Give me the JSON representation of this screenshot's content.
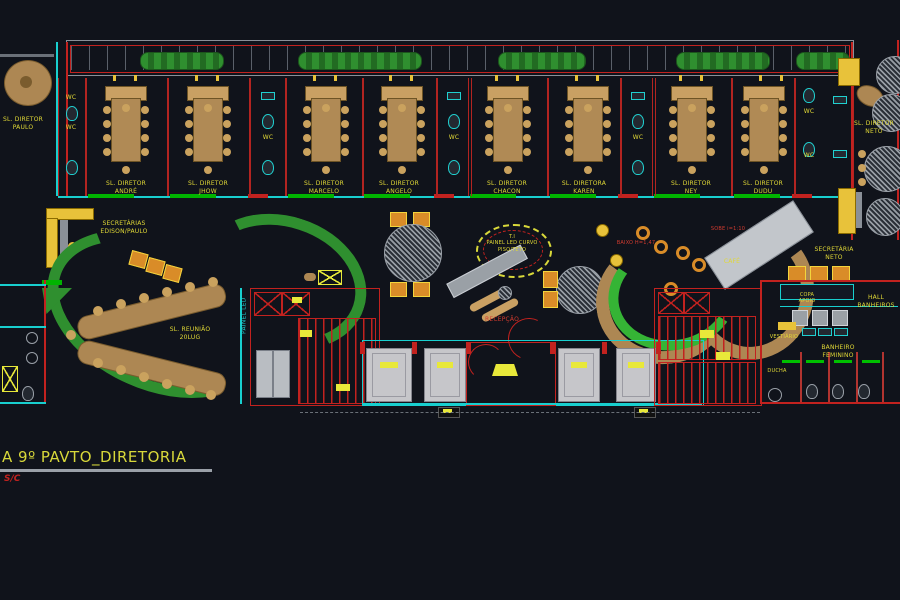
{
  "app": {
    "title": "A 9º PAVTO_DIRETORIA",
    "scale": "S/C"
  },
  "colors": {
    "background": "#10131b",
    "wall_cyan": "#18cfcf",
    "wall_red": "#c2221f",
    "wall_green": "#00b400",
    "label_yellow": "#e0d836",
    "furniture_tan": "#b08a55",
    "elevator_grey": "#c6c6ca",
    "plant_green": "#2f8f2f"
  },
  "rooms": {
    "director_paulo": "SL. DIRETOR\nPAULO",
    "director_andre": "SL. DIRETOR\nANDRÉ",
    "director_jhow": "SL. DIRETOR\nJHOW",
    "director_marcelo": "SL. DIRETOR\nMARCELO",
    "director_angelo": "SL. DIRETOR\nANGELO",
    "director_chacon": "SL. DIRETOR\nCHACON",
    "director_karen": "SL. DIRETORA\nKAREN",
    "director_ney": "SL. DIRETOR\nNEY",
    "director_dudu": "SL. DIRETOR\nDUDU",
    "director_neto": "SL. DIRETOR\nNETO",
    "secretarias_edison_paulo": "SECRETÁRIAS\nEDISON/PAULO",
    "secretaria_neto": "SECRETÁRIA\nNETO",
    "sala_reuniao": "SL. REUNIÃO\n20LUG",
    "painel_led": "PAINEL LED",
    "ti": "T.I\nPAINEL LED CURVO\nPISO/TETO",
    "recepcao": "RECEPÇÃO",
    "cafe": "CAFÉ",
    "ramp_down": "BAIXO H=1,47",
    "ramp_up": "SOBE i=1:10",
    "copa_apoio": "COPA\nAPOIO",
    "hall_banheiros": "HALL\nBANHEIROS",
    "vestiario": "VESTIÁRIO",
    "banheiro_feminino": "BANHEIRO\nFEMININO",
    "ducha": "DUCHA",
    "wc": "WC"
  }
}
